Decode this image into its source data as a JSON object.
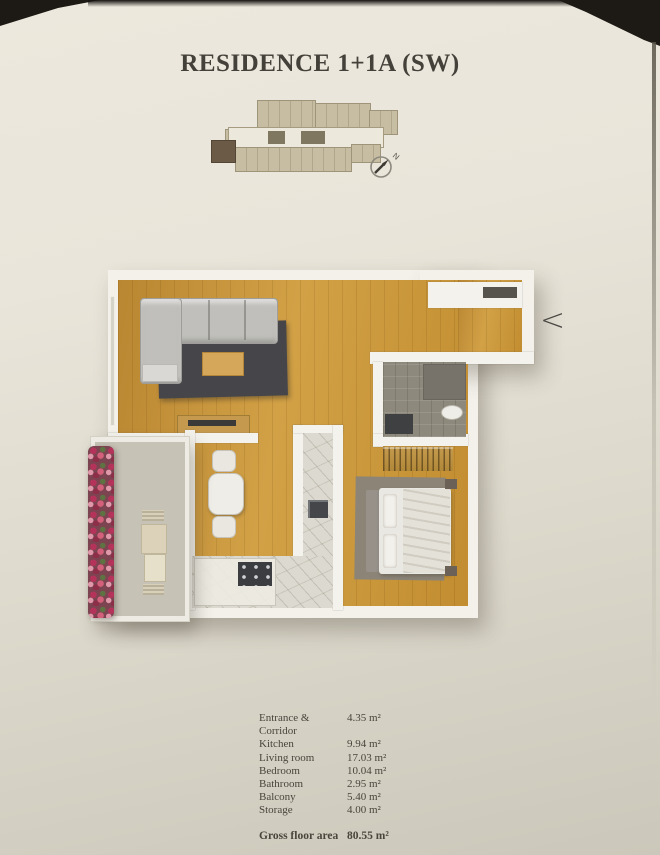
{
  "page": {
    "title": "RESIDENCE 1+1A (SW)"
  },
  "nav": {
    "prev_label": "<"
  },
  "key_plan": {
    "north_label": "N"
  },
  "areas": {
    "rows": [
      {
        "label": "Entrance & Corridor",
        "value": "4.35 m²"
      },
      {
        "label": "Kitchen",
        "value": "9.94 m²"
      },
      {
        "label": "Living room",
        "value": "17.03 m²"
      },
      {
        "label": "Bedroom",
        "value": "10.04 m²"
      },
      {
        "label": "Bathroom",
        "value": "2.95 m²"
      },
      {
        "label": "Balcony",
        "value": "5.40 m²"
      },
      {
        "label": "Storage",
        "value": "4.00 m²"
      }
    ],
    "total_label": "Gross floor area",
    "total_value": "80.55 m²"
  },
  "colors": {
    "page": "#e7e3d7",
    "wood_floor": "#c8953a",
    "wall": "#f3f1ea",
    "living_rug": "#46464a",
    "highlighted_unit": "#6b5a46",
    "flowers": "#b5335a"
  }
}
